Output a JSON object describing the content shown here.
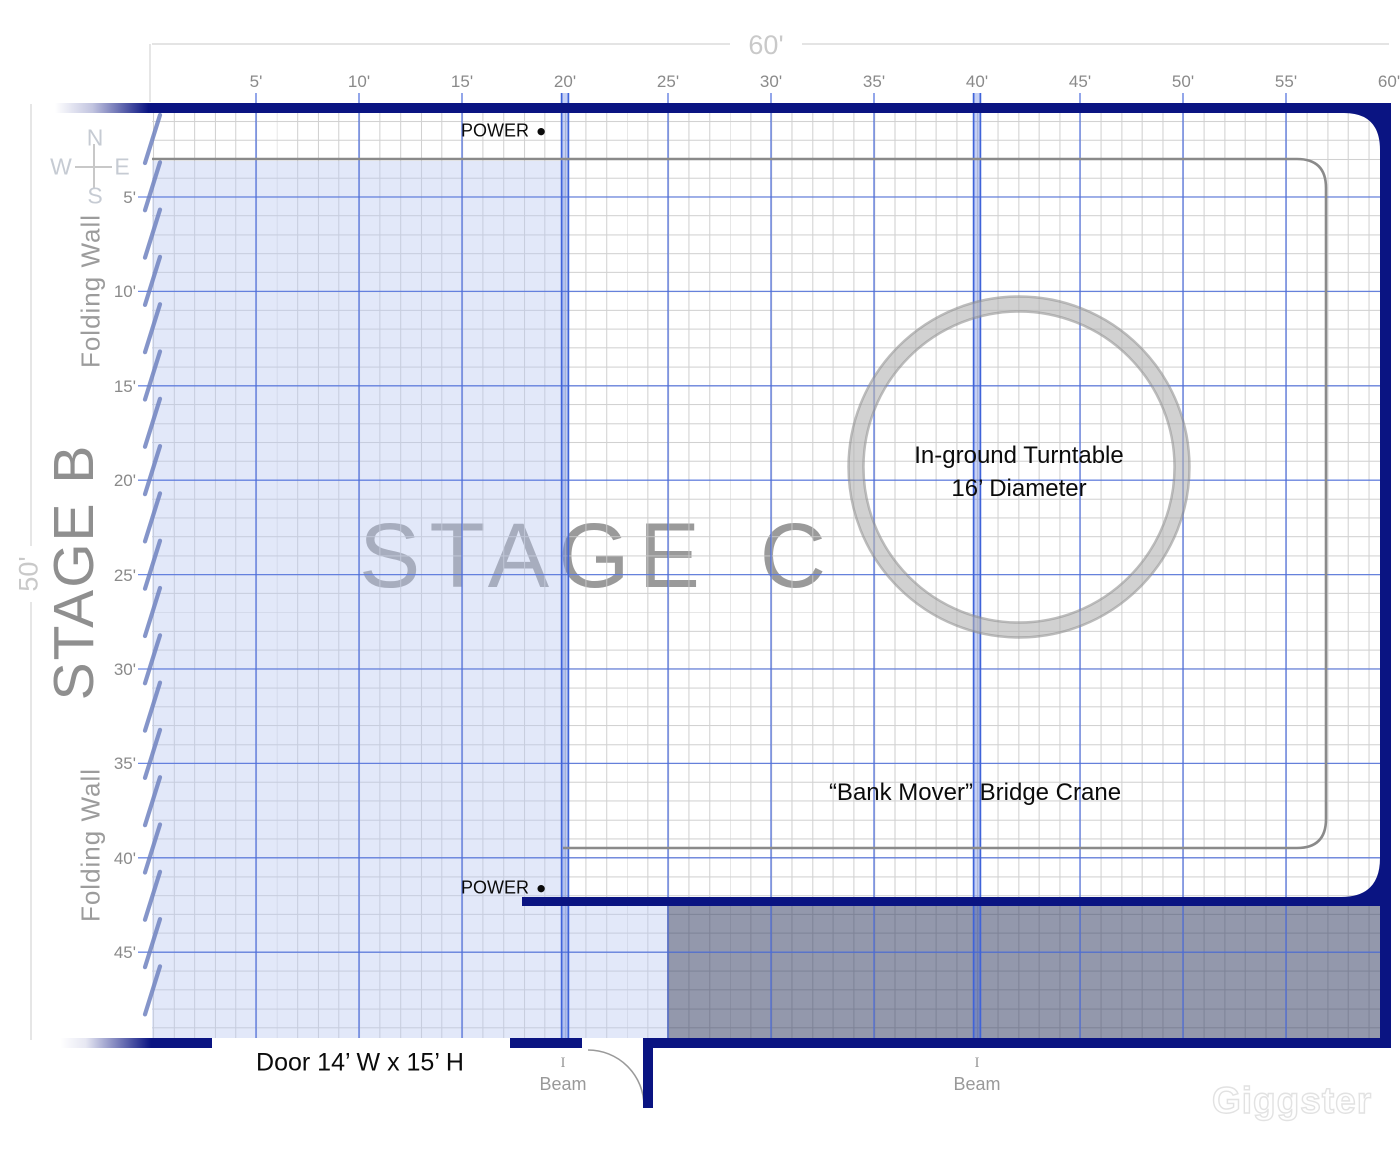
{
  "stage_plan": {
    "stage_c_title": "STAGE C",
    "stage_b_title": "STAGE B"
  },
  "rulers": {
    "top": {
      "dimension_label": "60'",
      "ticks": [
        "5'",
        "10'",
        "15'",
        "20'",
        "25'",
        "30'",
        "35'",
        "40'",
        "45'",
        "50'",
        "55'",
        "60'"
      ]
    },
    "left": {
      "dimension_label": "50'",
      "ticks": [
        "5'",
        "10'",
        "15'",
        "20'",
        "25'",
        "30'",
        "35'",
        "40'",
        "45'"
      ]
    }
  },
  "compass": {
    "n": "N",
    "w": "W",
    "e": "E",
    "s": "S"
  },
  "folding_wall": {
    "upper": "Folding Wall",
    "lower": "Folding Wall"
  },
  "annotations": {
    "power_top": "POWER",
    "power_bottom": "POWER",
    "power_dot": "●",
    "turntable_line1": "In-ground Turntable",
    "turntable_line2": "16’ Diameter",
    "bridge_crane": "“Bank Mover”  Bridge Crane",
    "door": "Door 14’ W x 15’ H",
    "beams": [
      {
        "i": "I",
        "label": "Beam"
      },
      {
        "i": "I",
        "label": "Beam"
      }
    ]
  },
  "watermark": {
    "text": "Giggster"
  },
  "colors": {
    "wall_navy": "#0a1482",
    "grid_major_blue": "#4a6bdc",
    "beam_blue": "#3f63d9",
    "grid_minor_gray": "#c9c9c9",
    "stage_b_fill": "#b9c7f0",
    "storage_fill": "#3a4468",
    "crane_gray": "#8a8a8a",
    "hatch_blue": "#7083c0",
    "dim_gray": "#d8d8d8"
  }
}
